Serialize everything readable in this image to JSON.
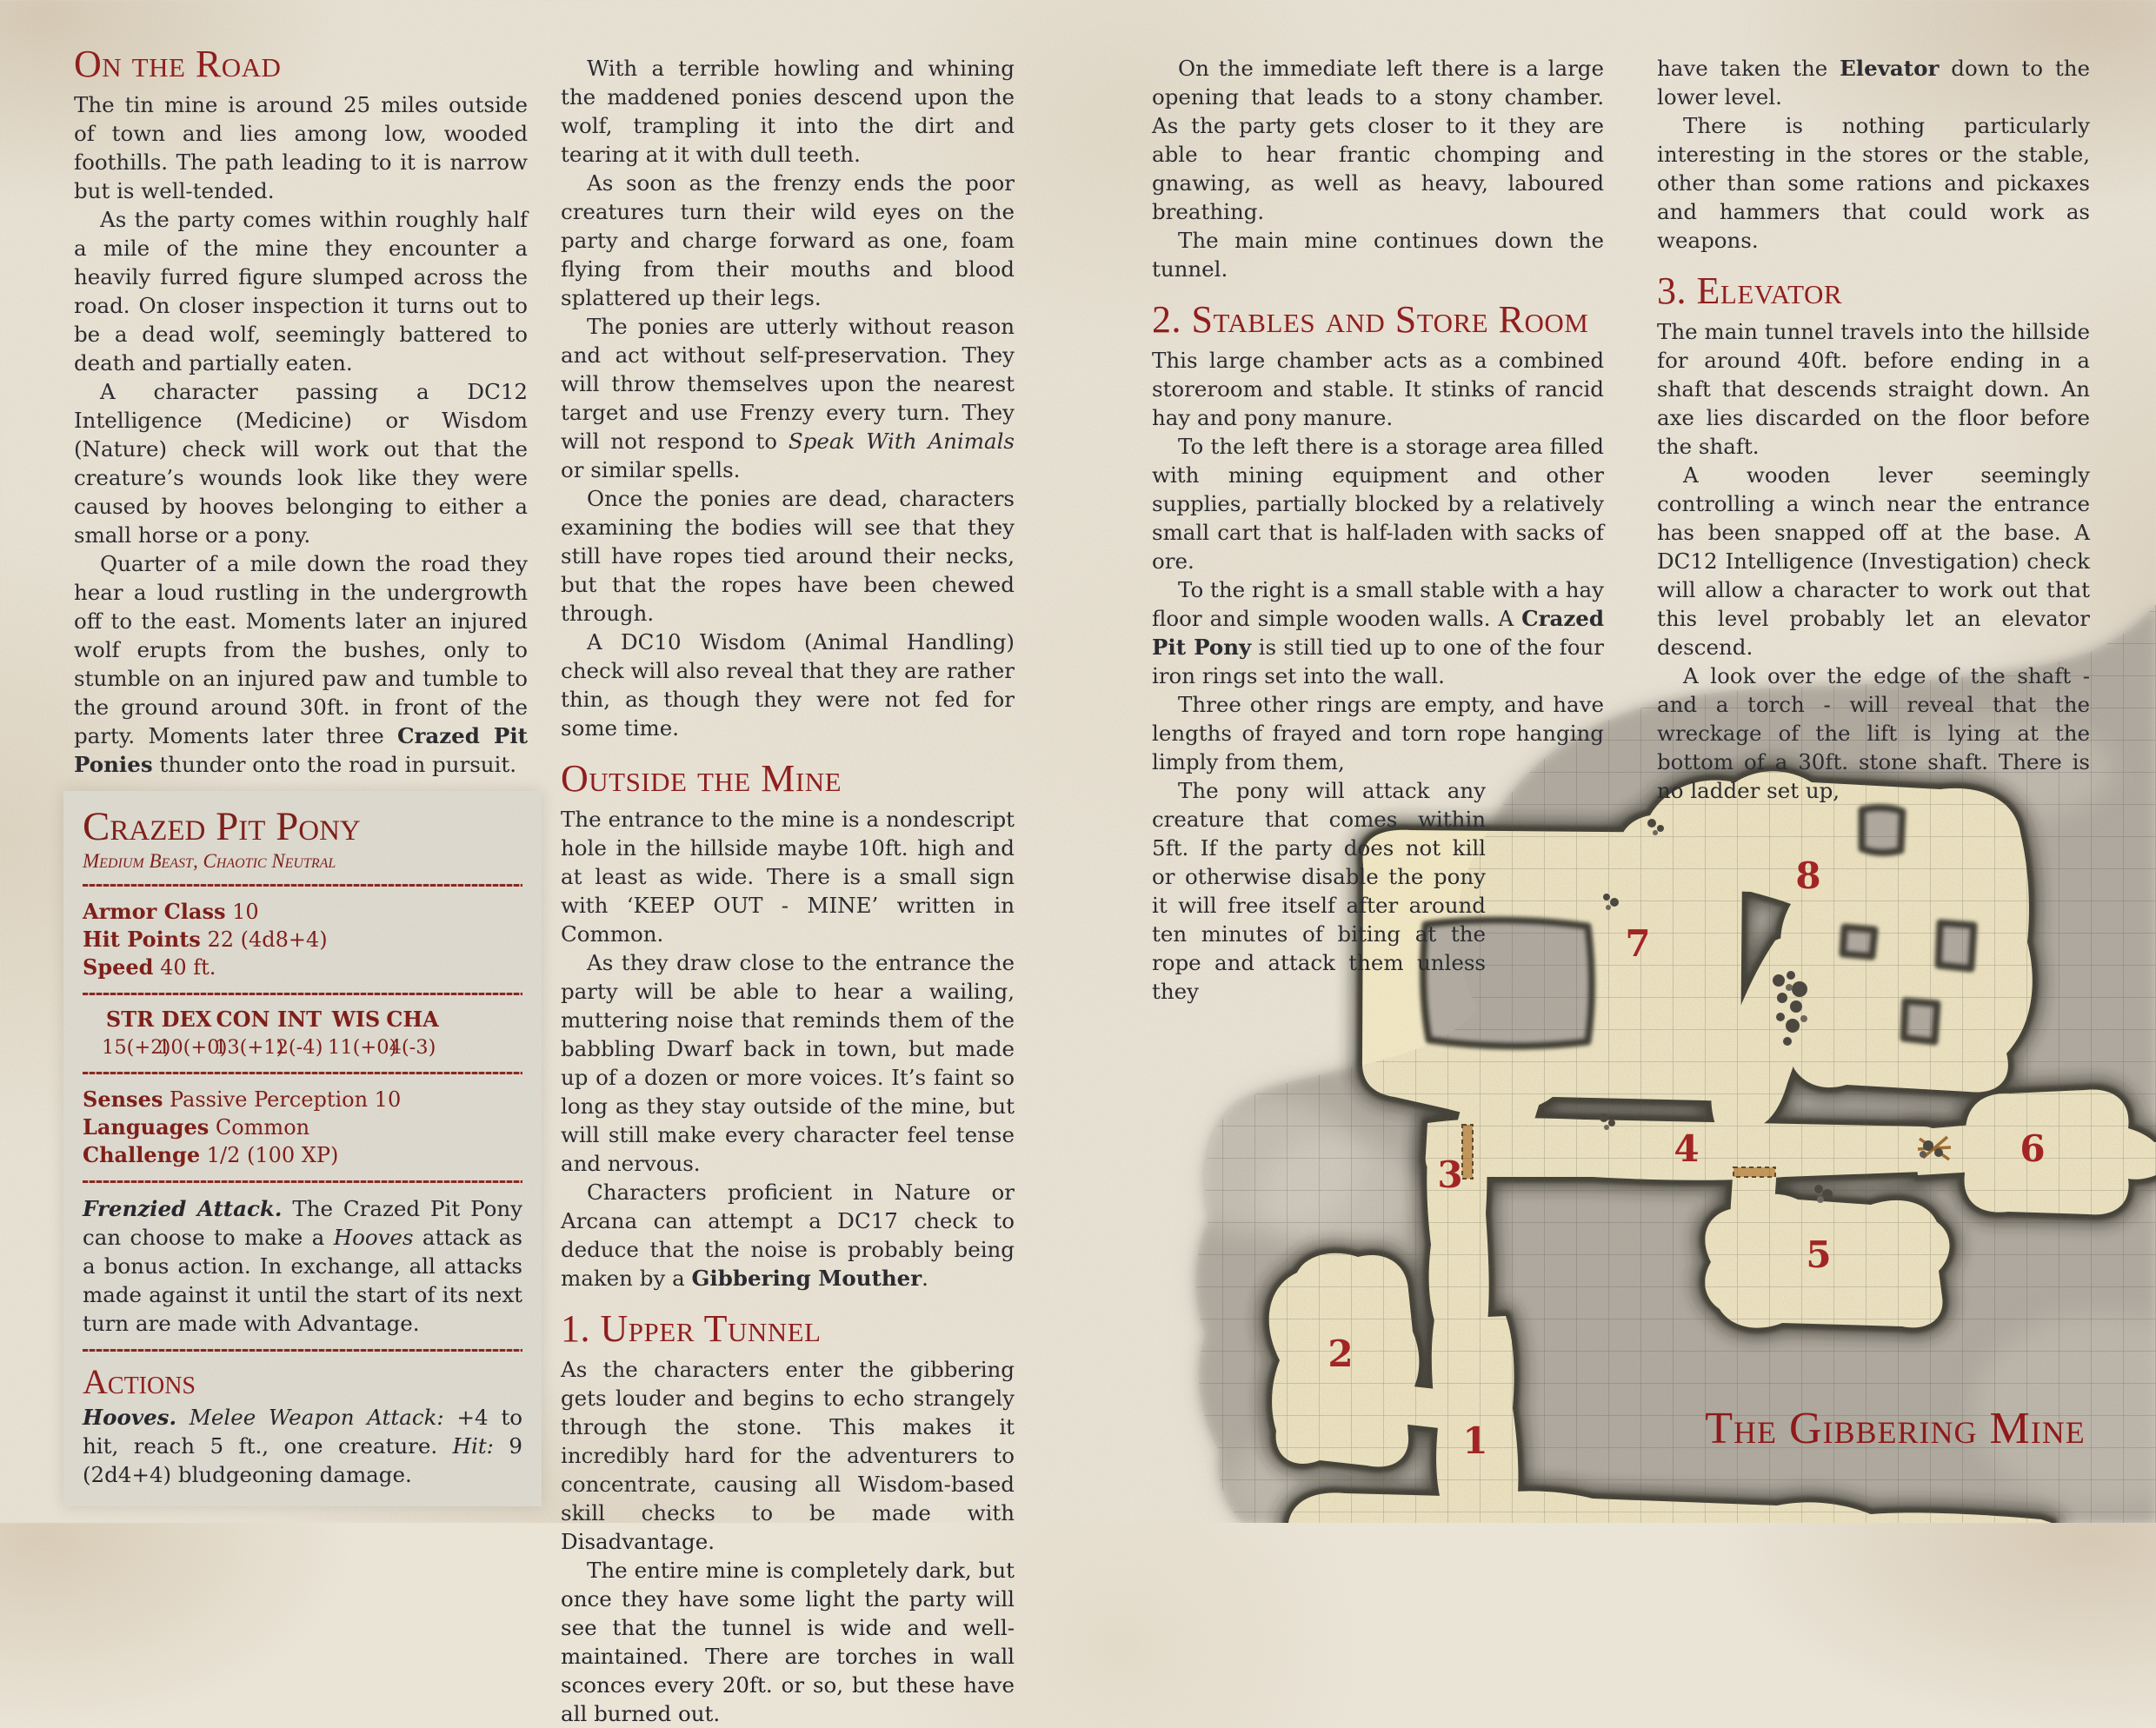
{
  "colors": {
    "heading_red": "#8e1a1a",
    "statblock_red": "#7d1a15",
    "body_text": "#26262c",
    "page_bg": "#eae4d7",
    "statblock_bg": "#dfdcd2",
    "map_stone": "#b3ada3",
    "map_floor": "#f3e9c6",
    "map_number_red": "#a32020",
    "map_title_red": "#8e1414"
  },
  "col1": {
    "heading": "On the Road",
    "paras": [
      "The tin mine is around 25 miles outside of town and lies among low, wooded foothills. The path leading to it is narrow but is well-tended.",
      "As the party comes within roughly half a mile of the mine they encounter a heavily furred figure slumped across the road. On closer inspection it turns out to be a dead wolf, seemingly battered to death and partially eaten.",
      "A character passing a DC12 Intelligence (Medicine) or Wisdom (Nature) check will work out that the creature’s wounds look like they were caused by hooves belonging to either a small horse or a pony.",
      "Quarter of a mile down the road they hear a loud rustling in the undergrowth off to the east. Moments later an injured wolf erupts from the bushes, only to stumble on an injured paw and tumble to the ground around 30ft. in front of the party. Moments later three <b>Crazed Pit Ponies</b> thunder onto the road in pursuit."
    ],
    "statblock": {
      "title": "Crazed Pit Pony",
      "subtitle": "Medium Beast, Chaotic Neutral",
      "stats": [
        {
          "label": "Armor Class",
          "value": "10"
        },
        {
          "label": "Hit Points",
          "value": "22 (4d8+4)"
        },
        {
          "label": "Speed",
          "value": "40 ft."
        }
      ],
      "abilities": [
        {
          "name": "STR",
          "value": "15(+2)"
        },
        {
          "name": "DEX",
          "value": "10(+0)"
        },
        {
          "name": "CON",
          "value": "13(+1)"
        },
        {
          "name": "INT",
          "value": "2(-4)"
        },
        {
          "name": "WIS",
          "value": "11(+0)"
        },
        {
          "name": "CHA",
          "value": "4(-3)"
        }
      ],
      "details": [
        {
          "label": "Senses",
          "value": "Passive Perception 10"
        },
        {
          "label": "Languages",
          "value": "Common"
        },
        {
          "label": "Challenge",
          "value": "1/2 (100 XP)"
        }
      ],
      "trait_html": "<b><i>Frenzied Attack.</i></b> The Crazed Pit Pony can choose to make a <i>Hooves</i> attack as a bonus action. In exchange, all attacks made against it until the start of its next turn are made with Advantage.",
      "actions_heading": "Actions",
      "action_html": "<b><i>Hooves.</i></b> <i>Melee Weapon Attack:</i> +4 to hit, reach 5 ft., one creature. <i>Hit:</i> 9 (2d4+4) bludgeoning damage."
    }
  },
  "col2": {
    "paras_top": [
      "With a terrible howling and whining the maddened ponies descend upon the wolf, trampling it into the dirt and tearing at it with dull teeth.",
      "As soon as the frenzy ends the poor creatures turn their wild eyes on the party and charge forward as one, foam flying from their mouths and blood splattered up their legs.",
      "The ponies are utterly without reason and act without self-preservation. They will throw themselves upon the nearest target and use Frenzy every turn. They will not respond to <i>Speak With Animals</i> or similar spells.",
      "Once the ponies are dead, characters examining the bodies will see that they still have ropes tied around their necks, but that the ropes have been chewed through.",
      "A DC10 Wisdom (Animal Handling) check will also reveal that they are rather thin, as though they were not fed for some time."
    ],
    "heading_outside": "Outside the Mine",
    "paras_outside": [
      "The entrance to the mine is a nondescript hole in the hillside maybe 10ft. high and at least as wide. There is a small sign with ‘KEEP OUT - MINE’ written in Common.",
      "As they draw close to the entrance the party will be able to hear a wailing, muttering noise that reminds them of the babbling Dwarf back in town, but made up of a dozen or more voices. It’s faint so long as they stay outside of the mine, but will still make every character feel tense and nervous.",
      "Characters proficient in Nature or Arcana can attempt a DC17 check to deduce that the noise is probably being maken by a <b>Gibbering Mouther</b>."
    ],
    "heading_tunnel": "1. Upper Tunnel",
    "paras_tunnel": [
      "As the characters enter the gibbering gets louder and begins to echo strangely through the stone. This makes it incredibly hard for the adventurers to concentrate, causing all Wisdom-based skill checks to be made with Disadvantage.",
      "The entire mine is completely dark, but once they have some light the party will see that the tunnel is wide and well-maintained. There are torches in wall sconces every 20ft. or so, but these have all burned out."
    ]
  },
  "col3": {
    "paras_top": [
      "On the immediate left there is a large opening that leads to a stony chamber. As the party gets closer to it they are able to hear frantic chomping and gnawing, as well as heavy, laboured breathing.",
      "The main mine continues down the tunnel."
    ],
    "heading": "2. Stables and Store Room",
    "paras": [
      "This large chamber acts as a combined storeroom and stable. It stinks of rancid hay and pony manure.",
      "To the left there is a storage area filled with mining equipment and other supplies, partially blocked by a relatively small cart that is half-laden with sacks of ore.",
      "To the right is a small stable with a hay floor and simple wooden walls. A <b>Crazed Pit Pony</b> is still tied up to one of the four iron rings set into the wall.",
      "Three other rings are empty, and have lengths of frayed and torn rope hanging limply from them,"
    ],
    "para_narrow": "The pony will attack any creature that comes within 5ft. If the party does not kill or otherwise disable the pony it will free itself after around ten minutes of biting at the rope and attack them unless they"
  },
  "col4": {
    "paras_top": [
      "have taken the <b>Elevator</b> down to the lower level.",
      "There is nothing particularly interesting in the stores or the stable, other than some rations and pickaxes and hammers that could work as weapons."
    ],
    "heading": "3. Elevator",
    "paras": [
      "The main tunnel travels into the hillside for around 40ft. before ending in a shaft that descends straight down. An axe lies discarded on the floor before the shaft.",
      "A wooden lever seemingly controlling a winch near the entrance has been snapped off at the base. A DC12 Intelligence (Investigation) check will allow a character to work out that this level probably let an elevator descend.",
      "A look over the edge of the shaft - and a torch - will reveal that the wreckage of the lift is lying at the bottom of a 30ft. stone shaft. There is no ladder set up,"
    ]
  },
  "map": {
    "title": "The Gibbering Mine",
    "rooms": [
      "1",
      "2",
      "3",
      "4",
      "5",
      "6",
      "7",
      "8"
    ]
  }
}
